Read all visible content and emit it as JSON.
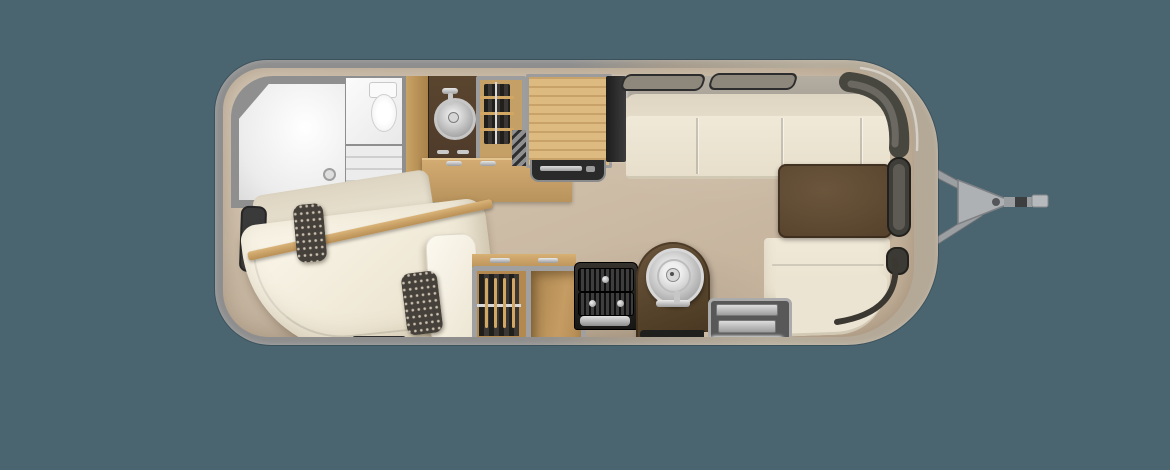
{
  "scene": {
    "type": "floor-plan-rendering",
    "subject": "travel-trailer-floorplan-top-view",
    "orientation": "hitch-on-right",
    "visible_text": "none"
  },
  "colors": {
    "bg": "#4a6470",
    "shellGray": "#8e8e8e",
    "shellChampagne": "#b7ad9c",
    "wallGray": "#8f8f8f",
    "wallBand": "#a9a399",
    "floorLight": "#d6c9b6",
    "floorMid": "#cdbca6",
    "floorDark": "#c1ae97",
    "roomWhite": "#efefef",
    "woodLight": "#dcba80",
    "wood": "#c9a266",
    "woodDark": "#b3894f",
    "counterDark": "#4a3628",
    "brownTable": "#57432d",
    "brownArch": "#5e4a31",
    "cream": "#f0e9d8",
    "creamDark": "#e5ddc9",
    "darkWindow": "#3f3e39",
    "darkTrim": "#45443f",
    "metal": "#c9c9c9",
    "speckle": "#45403a",
    "matDark": "#1f1f1d",
    "hitch": "#a3a6a8"
  },
  "features": {
    "trailer_body": "travel trailer body shell",
    "floor": "interior floor",
    "shower": "rear wet-bath shower",
    "toilet": "toilet",
    "vanity_sink": "bath vanity round sink",
    "wardrobe_rear": "hanging wardrobe (rear)",
    "dresser_counter": "wood dresser counter",
    "furnace_vent": "louvered vent",
    "galley_counter": "galley wood countertop",
    "range": "range cooktop front",
    "refrigerator": "refrigerator",
    "sofa": "curbside sofa bench",
    "window_1": "awning window 1",
    "window_2": "awning window 2",
    "front_wrap_window": "front wrap-around window",
    "front_side_window": "front side window",
    "front_lower_window": "front lower window",
    "dinette_table": "front dinette table",
    "dinette_bench": "front wrap-around dinette bench",
    "bed": "rear corner bed mattress",
    "bed_backrest": "bed backrest cushions",
    "bed_rail": "wood bed rail",
    "pillow_white": "white pillow",
    "accent_pillow": "speckled accent pillow",
    "rear_panel": "rear wall dark panel",
    "wardrobe_mid": "hanging wardrobe (mid)",
    "open_shelf": "open shelf cabinet",
    "drawer_chest": "dark drawer chest",
    "sink_peninsula": "arched sink peninsula cabinet",
    "round_sink": "round stainless sink",
    "entry_step": "entry door step",
    "floor_mat": "entry floor mat",
    "hitch": "tow hitch a-frame",
    "coupler": "hitch coupler"
  }
}
